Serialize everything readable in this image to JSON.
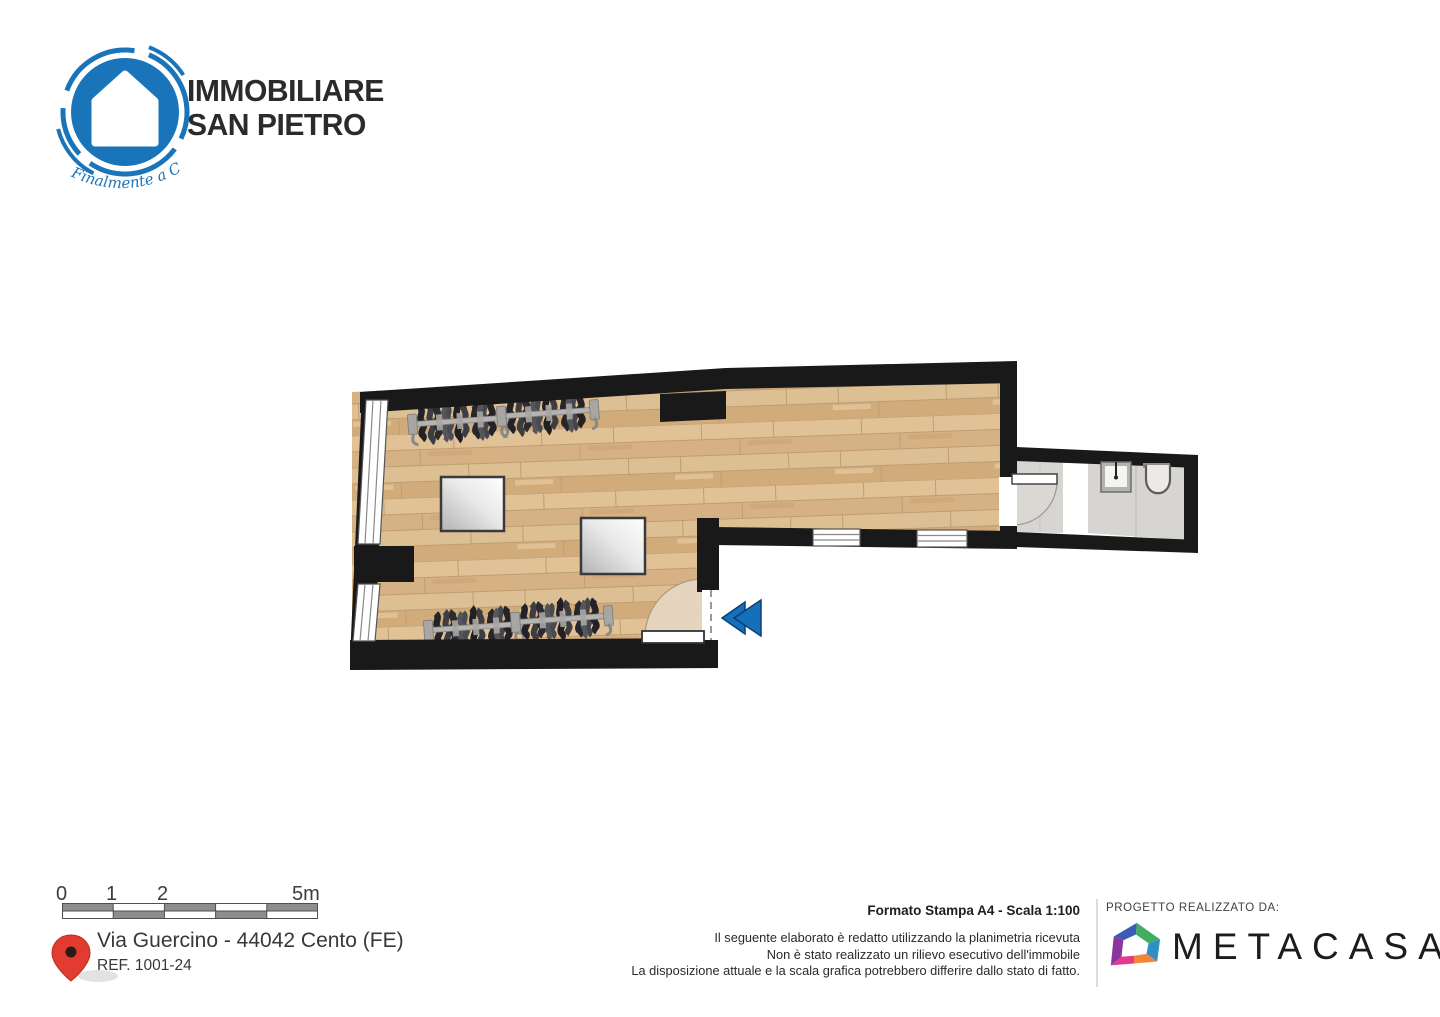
{
  "header_logo": {
    "line1": "IMMOBILIARE",
    "line2": "SAN PIETRO",
    "tagline": "Finalmente a Casa",
    "brand_color": "#1a74ba",
    "text_color": "#2b2b2b"
  },
  "floorplan": {
    "colors": {
      "wall": "#191919",
      "wood_floor": "#dcbb8e",
      "tile_floor": "#d7d5d2",
      "entrance_arrow": "#1470b8",
      "door_swing": "#e5d6c1"
    }
  },
  "scale_bar": {
    "labels": [
      "0",
      "1",
      "2",
      "5m"
    ]
  },
  "location": {
    "address": "Via Guercino - 44042 Cento (FE)",
    "reference": "REF. 1001-24",
    "pin_color": "#e23b30"
  },
  "print_info": {
    "format": "Formato Stampa A4 - Scala 1:100",
    "disclaimer": [
      "Il seguente elaborato è redatto utilizzando la planimetria ricevuta",
      "Non è stato realizzato un rilievo esecutivo dell'immobile",
      "La disposizione attuale e la scala grafica potrebbero differire dallo stato di fatto."
    ]
  },
  "credits": {
    "label": "PROGETTO REALIZZATO DA:",
    "brand": "METACASA"
  }
}
